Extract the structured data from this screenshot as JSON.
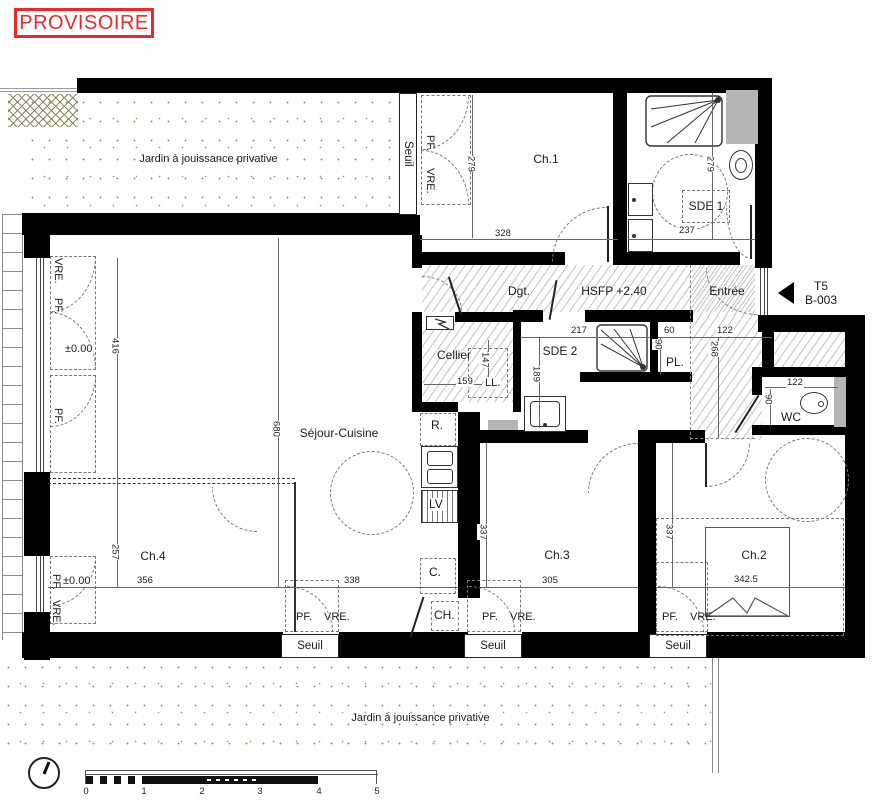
{
  "stamp": "PROVISOIRE",
  "unit": {
    "type": "T5",
    "ref": "B-003"
  },
  "garden_label": "Jardin à jouissance privative",
  "rooms": {
    "ch1": "Ch.1",
    "sde1": "SDE 1",
    "dgt": "Dgt.",
    "hsfp": "HSFP +2.40",
    "entree": "Entrée",
    "cellier": "Cellier",
    "sde2": "SDE 2",
    "pl": "PL.",
    "wc": "WC",
    "sejour": "Séjour-Cuisine",
    "ch4": "Ch.4",
    "ch3": "Ch.3",
    "ch2": "Ch.2"
  },
  "fixtures": {
    "fridge": "R.",
    "dishwasher": "LV",
    "hob": "C.",
    "boiler": "CH.",
    "washer": "LL."
  },
  "openings": {
    "seuil": "Seuil",
    "pf": "PF.",
    "vre": "VRE."
  },
  "levels": {
    "zero": "±0.00"
  },
  "dims": {
    "d279": "279",
    "d328": "328",
    "d237": "237",
    "d217": "217",
    "d60": "60",
    "d90": "90",
    "d122": "122",
    "d268": "268",
    "d159": "159",
    "d147": "147",
    "d189": "189",
    "d416": "416",
    "d680": "680",
    "d257": "257",
    "d356": "356",
    "d338": "338",
    "d337": "337",
    "d305": "305",
    "d342_5": "342.5"
  },
  "scalebar": {
    "ticks": [
      "0",
      "1",
      "2",
      "3",
      "4",
      "5"
    ]
  },
  "colors": {
    "stamp_red": "#e52b2b",
    "wall": "#000000",
    "duct_gray": "#b5b5b5",
    "garden_dot": "#99996a"
  }
}
